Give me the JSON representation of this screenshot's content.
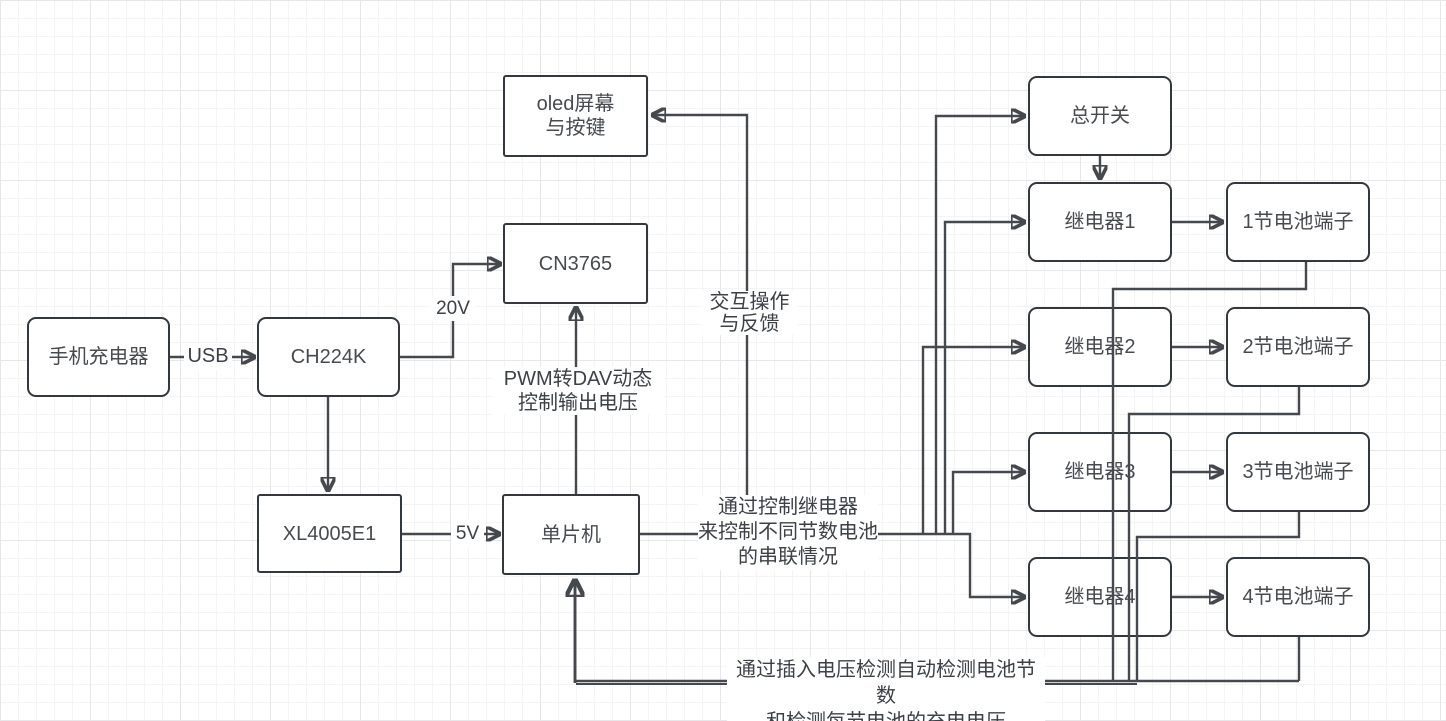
{
  "diagram": {
    "type": "flowchart",
    "language": "zh-CN",
    "colors": {
      "background": "#ffffff",
      "node_border": "#33383e",
      "node_fill": "#ffffff",
      "wire": "#45494e",
      "text": "#42474d",
      "grid_minor": "#f4f4f5",
      "grid_major": "#e7e7e9"
    },
    "nodes": [
      {
        "id": "phone-charger",
        "label": "手机充电器"
      },
      {
        "id": "ch224k",
        "label": "CH224K"
      },
      {
        "id": "xl4005e1",
        "label": "XL4005E1"
      },
      {
        "id": "cn3765",
        "label": "CN3765"
      },
      {
        "id": "oled",
        "label": "oled屏幕\n与按键"
      },
      {
        "id": "mcu",
        "label": "单片机"
      },
      {
        "id": "main-switch",
        "label": "总开关"
      },
      {
        "id": "relay1",
        "label": "继电器1"
      },
      {
        "id": "terminal1",
        "label": "1节电池端子"
      },
      {
        "id": "relay2",
        "label": "继电器2"
      },
      {
        "id": "terminal2",
        "label": "2节电池端子"
      },
      {
        "id": "relay3",
        "label": "继电器3"
      },
      {
        "id": "terminal3",
        "label": "3节电池端子"
      },
      {
        "id": "relay4",
        "label": "继电器4"
      },
      {
        "id": "terminal4",
        "label": "4节电池端子"
      }
    ],
    "wire_labels": [
      {
        "id": "usb",
        "text": "USB"
      },
      {
        "id": "v20",
        "text": "20V"
      },
      {
        "id": "v5",
        "text": "5V"
      },
      {
        "id": "pwm",
        "text": "PWM转DAV动态\n控制输出电压"
      },
      {
        "id": "interaction",
        "text": "交互操作\n与反馈"
      },
      {
        "id": "relay-control",
        "text": "通过控制继电器\n来控制不同节数电池\n的串联情况"
      },
      {
        "id": "detection",
        "text": "通过插入电压检测自动检测电池节数\n和检测每节电池的充电电压"
      }
    ],
    "edges": [
      "手机充电器 -USB-> CH224K",
      "CH224K -20V-> CN3765",
      "CH224K -> XL4005E1",
      "XL4005E1 -5V-> 单片机",
      "单片机 -PWM转DAV动态控制输出电压-> CN3765",
      "单片机 -交互操作与反馈-> oled屏幕与按键",
      "单片机 -通过控制继电器来控制不同节数电池的串联情况-> 总开关/继电器1/继电器2/继电器3/继电器4",
      "总开关 -> 继电器1",
      "继电器1 -> 1节电池端子",
      "继电器2 -> 2节电池端子",
      "继电器3 -> 3节电池端子",
      "继电器4 -> 4节电池端子",
      "电池端子1-4 -通过插入电压检测自动检测电池节数和检测每节电池的充电电压-> 单片机"
    ]
  }
}
